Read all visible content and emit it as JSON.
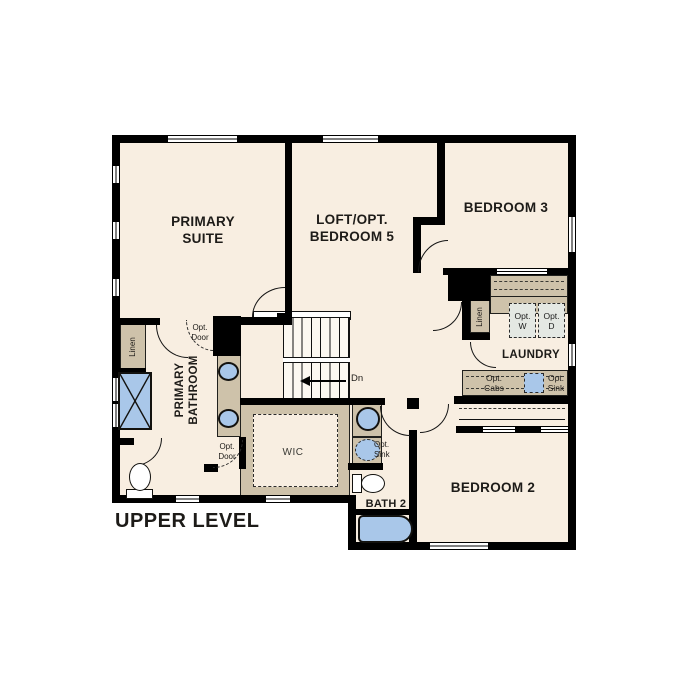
{
  "title": "UPPER LEVEL",
  "rooms": {
    "primary_suite": "PRIMARY\nSUITE",
    "loft": "LOFT/OPT.\nBEDROOM 5",
    "bedroom3": "BEDROOM 3",
    "bedroom2": "BEDROOM 2",
    "bath2": "BATH 2",
    "laundry": "LAUNDRY",
    "primary_bathroom": "PRIMARY\nBATHROOM",
    "wic": "WIC"
  },
  "annotations": {
    "linen_bath": "Linen",
    "linen_hall": "Linen",
    "opt_door_upper": "Opt.\nDoor",
    "opt_door_lower": "Opt.\nDoor",
    "opt_washer": "Opt.\nW",
    "opt_dryer": "Opt.\nD",
    "opt_cabs": "Opt.\nCabs",
    "opt_sink_laundry": "Opt.\nSink",
    "opt_sink_bath2": "Opt.\nSink",
    "stairs_down": "Dn"
  },
  "colors": {
    "wall": "#000000",
    "room_fill": "#f8eee1",
    "cabinet_fill": "#cec2aa",
    "fixture_blue": "#a9c7e9",
    "optional_fill": "#e4e8e3",
    "text": "#1a1a1a"
  }
}
